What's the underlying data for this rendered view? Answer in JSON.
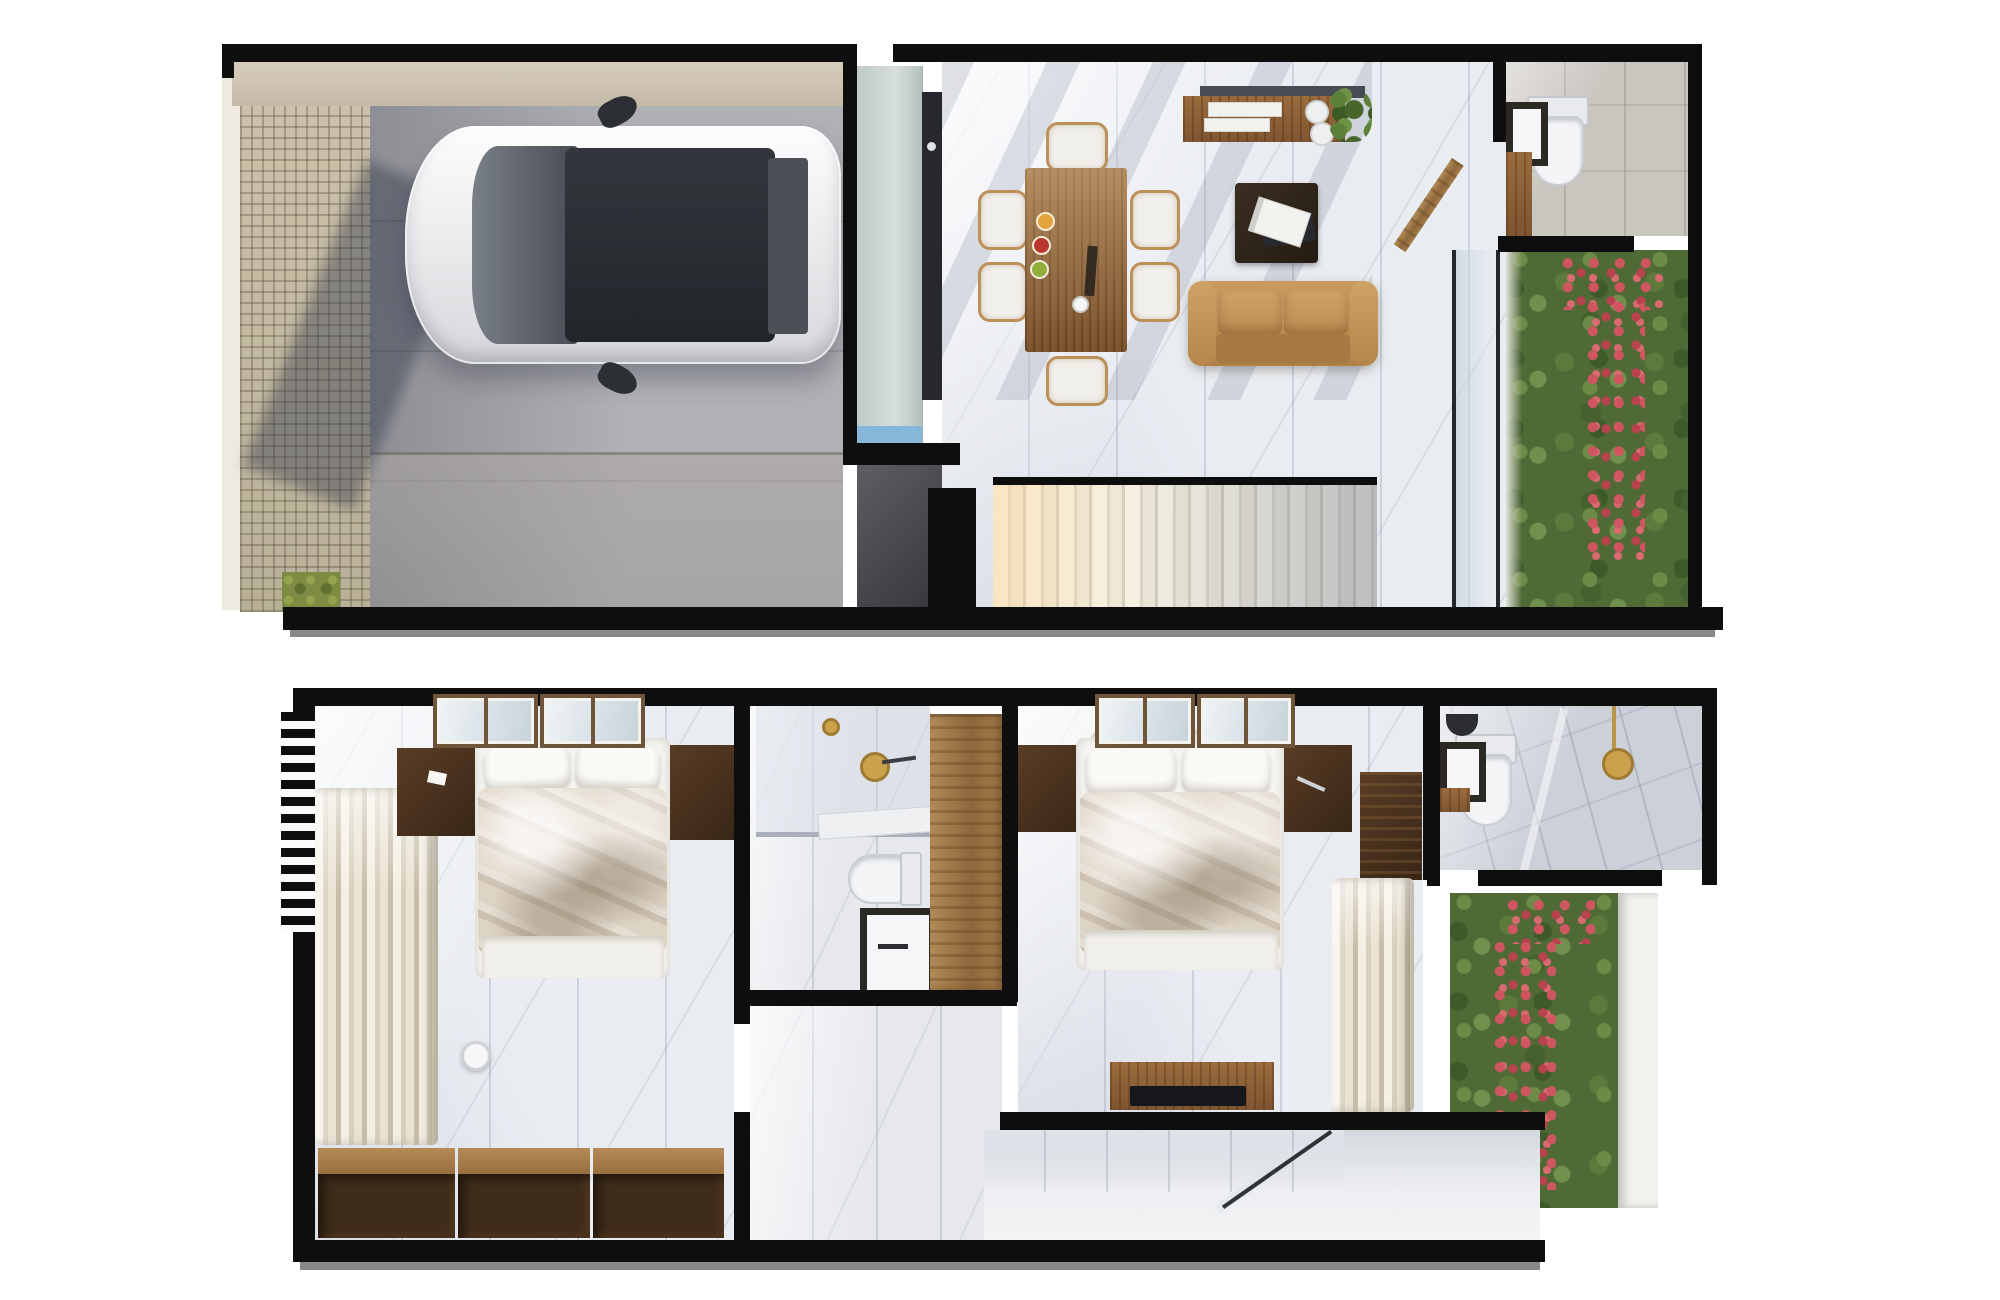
{
  "image": {
    "kind": "3d-floor-plan-render",
    "view": "top-down dollhouse",
    "floors_shown": 2,
    "visible_text": ""
  },
  "colors": {
    "wall": "#0e0e0f",
    "marble": "#e9ecf1",
    "garage_floor": "#a2a3a8",
    "cobble": "#c8bea7",
    "grass": "#7d8c42",
    "cabinet": "#d6dedb",
    "counter": "#26282d",
    "counter_accent": "#86b7d9",
    "wood": "#8d5f35",
    "sofa": "#c99b60",
    "garden": "#4f6a35",
    "flower": "#cf5560",
    "fixture": "#f4f5f7",
    "gold": "#caa24c",
    "car_glass": "#33373d"
  },
  "floors": [
    {
      "id": "first-floor",
      "rooms": [
        "driveway",
        "garage",
        "kitchen",
        "dining-room",
        "living-room",
        "hallway",
        "bathroom",
        "vertical-garden",
        "staircase"
      ],
      "furniture": [
        "car",
        "tall-cabinet",
        "counter",
        "dining-table",
        "dining-chairs-x6",
        "console-sideboard",
        "coffee-table",
        "sofa",
        "toilet",
        "sink",
        "open-door"
      ]
    },
    {
      "id": "second-floor",
      "rooms": [
        "bedroom-1",
        "closet-1",
        "bathroom-1",
        "hallway",
        "bedroom-2",
        "closet-2",
        "bathroom-2",
        "vertical-garden",
        "stairwell"
      ],
      "furniture": [
        "bed-1",
        "nightstands",
        "shelf-cubbies",
        "hanging-clothes",
        "toilet",
        "vanity-sink",
        "shower",
        "wardrobe",
        "bed-2",
        "tv-console",
        "glass-balustrade"
      ]
    }
  ]
}
